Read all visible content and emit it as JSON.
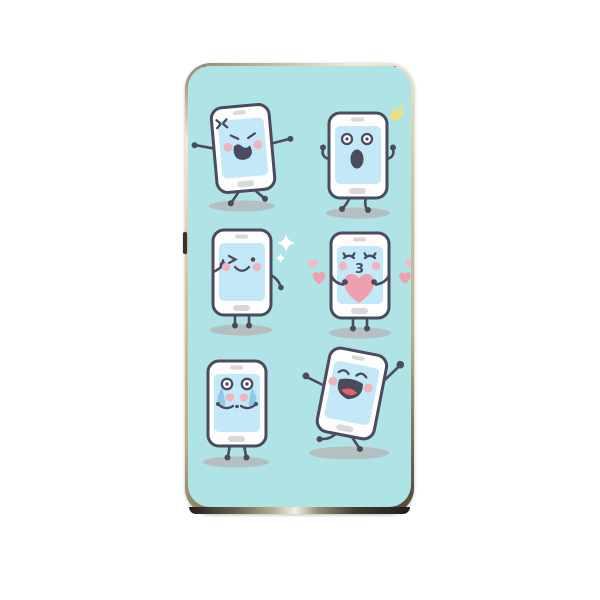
{
  "product": {
    "name": "phone-case",
    "description": "Gold-framed phone case printed with six cartoon smartphone emoji characters on a mint background"
  },
  "colors": {
    "page_bg": "#ffffff",
    "case_bg": "#b0e3e5",
    "gold_light": "#f0ead0",
    "gold_mid": "#cdc49e",
    "gold_dark": "#8a8266",
    "bezel_dark": "#211e19",
    "outline": "#4b4b5e",
    "body": "#fdfdfe",
    "screen": "#c3e9f8",
    "detail": "#d8d8da",
    "cheek": "#f2b3c1",
    "heart": "#ef9fae",
    "heart_light": "#f5b8c4",
    "tear": "#8ccbe8",
    "tongue": "#e8606e",
    "sparkle_yellow": "#ece17e",
    "sparkle_white": "#ffffff",
    "shadow": "#b6b9bd"
  },
  "characters": [
    {
      "emotion": "angry",
      "icon": "anger-mark-icon",
      "position": "top-left"
    },
    {
      "emotion": "surprised",
      "icon": "sparkle-flash-icon",
      "position": "top-right"
    },
    {
      "emotion": "winking",
      "icon": "sparkle-diamond-icon",
      "position": "middle-left"
    },
    {
      "emotion": "kissing",
      "icon": "heart-icon",
      "position": "middle-right",
      "mouth_glyph": "3"
    },
    {
      "emotion": "crying",
      "icon": "tear-icon",
      "position": "bottom-left"
    },
    {
      "emotion": "dancing",
      "icon": "",
      "position": "bottom-right"
    }
  ],
  "device": {
    "side_button": "volume-button"
  }
}
